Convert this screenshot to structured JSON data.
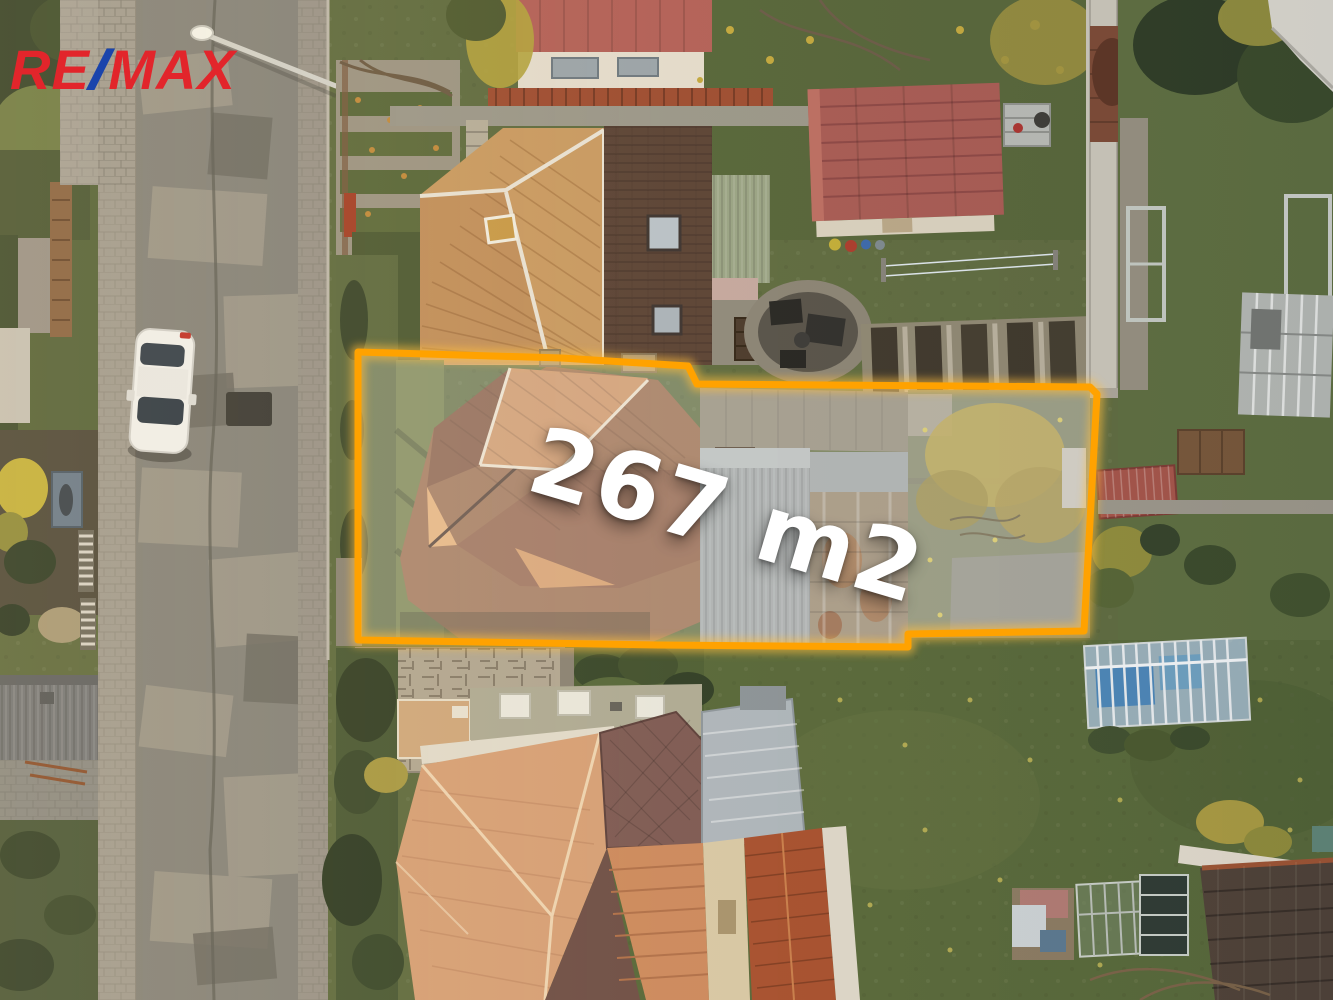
{
  "watermark": {
    "re": "RE",
    "slash": "/",
    "max": "MAX"
  },
  "overlay": {
    "area_label": "267 m2"
  },
  "colors": {
    "logo-red": "#E2252B",
    "logo-blue": "#1A44AC",
    "boundary": "#FFA200",
    "boundary-glow": "#FFBE3C",
    "label-text": "#FFFFFF"
  }
}
